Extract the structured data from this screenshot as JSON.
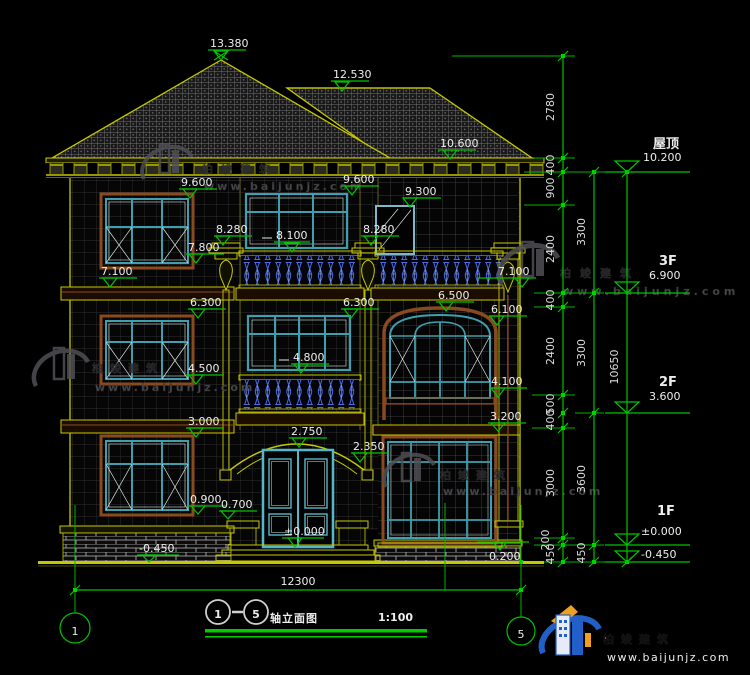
{
  "drawing": {
    "marks": {
      "m13380": "13.380",
      "m12530": "12.530",
      "m10600": "10.600",
      "m9600L": "9.600",
      "m9600M": "9.600",
      "m9300": "9.300",
      "m8280L": "8.280",
      "m8100": "8.100",
      "m8280M": "8.280",
      "m7800": "7.800",
      "m7100L": "7.100",
      "m7100R": "7.100",
      "m6300L": "6.300",
      "m6300M": "6.300",
      "m6500": "6.500",
      "m6100": "6.100",
      "m4800": "4.800",
      "m4500": "4.500",
      "m4100": "4.100",
      "m3200": "3.200",
      "m3000": "3.000",
      "m2750": "2.750",
      "m2350": "2.350",
      "m0900": "0.900",
      "m0700": "0.700",
      "m0000": "±0.000",
      "mneg0450": "-0.450",
      "m0200": "0.200"
    },
    "chains": {
      "a": [
        "2780",
        "400",
        "900",
        "2400",
        "400",
        "2400",
        "500",
        "400",
        "3000",
        "200",
        "450"
      ],
      "b": [
        "3300",
        "3300",
        "3600",
        "450"
      ],
      "c": [
        "10650"
      ]
    },
    "floors": [
      {
        "name": "屋顶",
        "elev": "10.200"
      },
      {
        "name": "3F",
        "elev": "6.900"
      },
      {
        "name": "2F",
        "elev": "3.600"
      },
      {
        "name": "1F",
        "elev": "±0.000"
      },
      {
        "name": "",
        "elev": "-0.450"
      }
    ],
    "bottom_dim": "12300",
    "axis": {
      "left": "1",
      "right": "5"
    }
  },
  "title_block": {
    "start": "1",
    "end": "5",
    "title": "轴立面图",
    "scale": "1:100"
  },
  "watermark": {
    "brand": "柏竣建筑",
    "url": "www.baijunjz.com"
  },
  "logo": {
    "brand": "柏竣建筑",
    "url": "www.baijunjz.com"
  },
  "colors": {
    "background": "#000000",
    "dim_green": "#00c400",
    "cad_yellow": "#c8c800",
    "frame_brown": "#8a4a20",
    "window_teal": "#3f9fae",
    "baluster_blue": "#4a6ce0",
    "text_white": "#ededed",
    "watermark_gray": "#54545a",
    "logo_blue": "#2060c8",
    "logo_orange": "#f0a020"
  }
}
